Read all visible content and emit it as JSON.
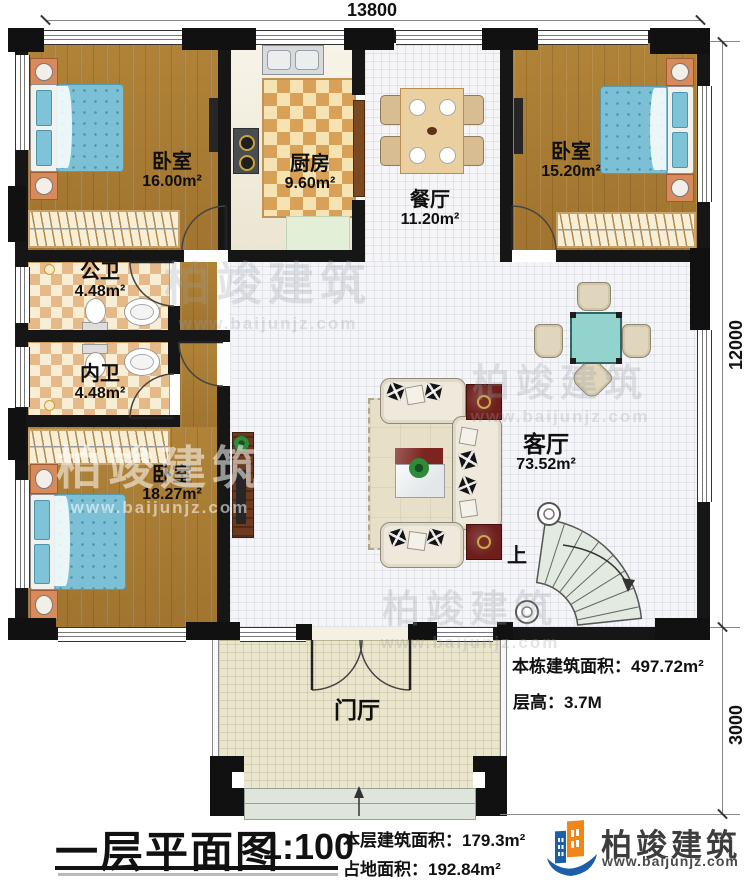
{
  "dimensions": {
    "top": "13800",
    "right_upper": "12000",
    "right_lower": "3000"
  },
  "rooms": {
    "bedroom_top_left": {
      "name": "卧室",
      "area": "16.00m²"
    },
    "kitchen": {
      "name": "厨房",
      "area": "9.60m²"
    },
    "dining": {
      "name": "餐厅",
      "area": "11.20m²"
    },
    "bedroom_top_right": {
      "name": "卧室",
      "area": "15.20m²"
    },
    "bath_public": {
      "name": "公卫",
      "area": "4.48m²"
    },
    "bath_inner": {
      "name": "内卫",
      "area": "4.48m²"
    },
    "bedroom_bottom_left": {
      "name": "卧室",
      "area": "18.27m²"
    },
    "living": {
      "name": "客厅",
      "area": "73.52m²"
    },
    "foyer": {
      "name": "门厅"
    },
    "stairs": {
      "up_label": "上"
    }
  },
  "annotations": {
    "total_building_area": "本栋建筑面积：497.72m²",
    "floor_height": "层高：3.7M"
  },
  "footer": {
    "title": "一层平面图",
    "scale": "1:100",
    "floor_area": "本层建筑面积：179.3m²",
    "land_area": "占地面积：192.84m²"
  },
  "logo": {
    "name": "柏竣建筑",
    "url": "www.baijunjz.com"
  },
  "watermark": {
    "name": "柏竣建筑",
    "url": "www.baijunjz.com"
  },
  "colors": {
    "wall": "#161616",
    "wood_floor": "#aa7e3c",
    "accent_blue": "#1c5fa8",
    "accent_orange": "#f08519",
    "bed_blue": "#7cc0d6",
    "mahjong_teal": "#93d3cd"
  }
}
